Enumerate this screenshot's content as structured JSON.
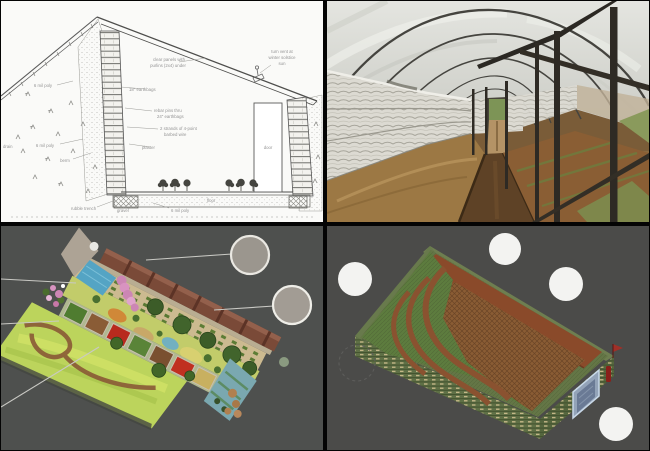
{
  "panels": {
    "diagram": {
      "name": "underground-greenhouse-cross-section-diagram",
      "ink": "#5a5a5a",
      "label_color": "#8f8f8f",
      "labels": [
        "clear panels with",
        "purlins (2x4) under",
        "18\" earthbags",
        "rebar pins thru",
        "24\" earthbags",
        "2 strands of 4-point",
        "barbed wire",
        "plaster",
        "turn vent at",
        "winter solstice",
        "sun",
        "6 mil poly",
        "6 mil poly",
        "berm",
        "drain",
        "rubble trench",
        "gravel",
        "6 mil poly",
        "floor",
        "door"
      ]
    },
    "photo": {
      "name": "earthbag-hoophouse-interior-photo",
      "frame_color": "#2e2a24",
      "bag_color": "#dcdad2",
      "soil_color": "#9c7844"
    },
    "garden_render": {
      "name": "garden-3d-render",
      "background": "#4e504e",
      "callout_fill": "#9b968e",
      "callout_stroke": "#eae8e2",
      "leader_color": "#c9c9c4"
    },
    "model_render": {
      "name": "earthbag-structure-3d-model",
      "background": "#4b4b49",
      "callout_fill": "#f3f3f1",
      "wall_green": "#5f7046",
      "floor_brown": "#8a5c34",
      "door_blue": "#93a3b8"
    }
  }
}
